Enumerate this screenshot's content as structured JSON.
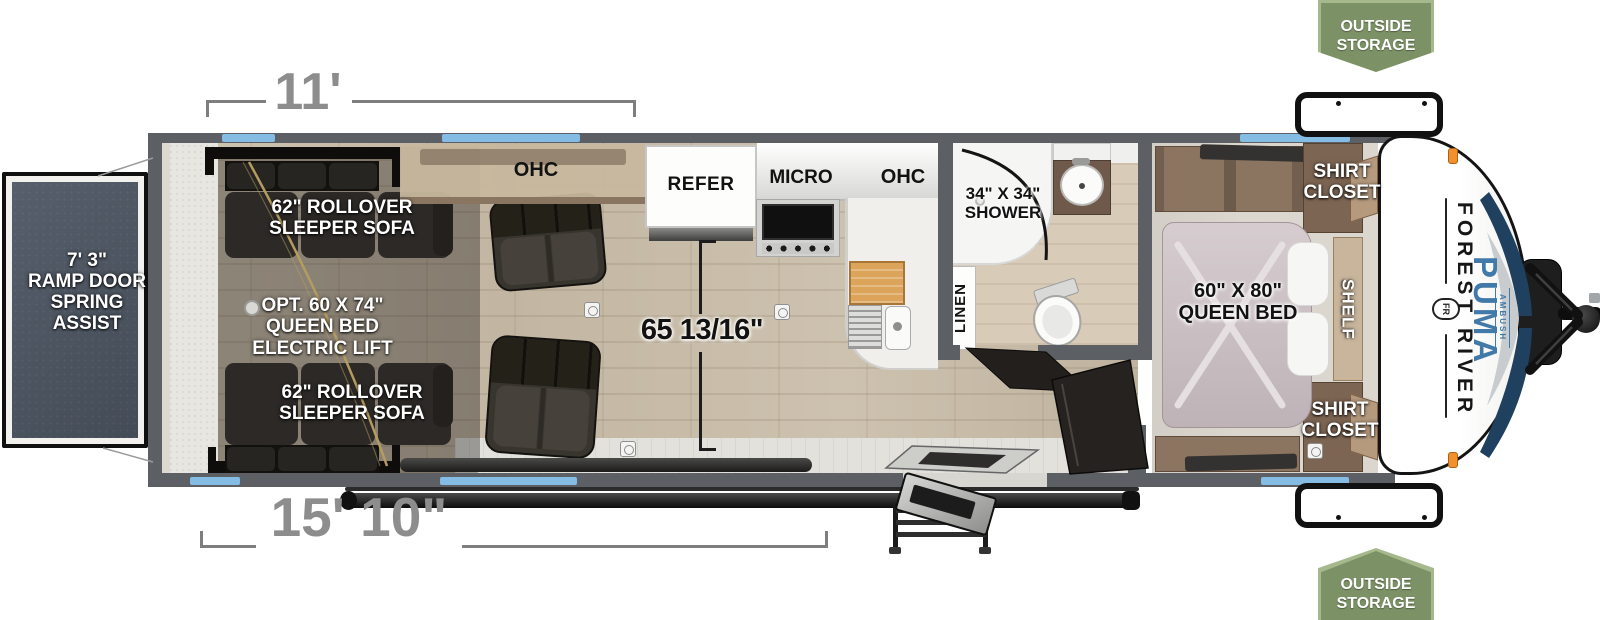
{
  "badges": {
    "top": {
      "label": "OUTSIDE STORAGE"
    },
    "bottom": {
      "label": "OUTSIDE STORAGE"
    }
  },
  "dimensions": {
    "garage_length": "11'",
    "cargo_length": "15' 10\"",
    "interior_width": "65 13/16\"",
    "ramp": "7' 3\"\nRAMP DOOR\nSPRING ASSIST"
  },
  "garage": {
    "sofa_top": "62\" ROLLOVER\nSLEEPER SOFA",
    "sofa_bottom": "62\" ROLLOVER\nSLEEPER SOFA",
    "bed_option": "OPT. 60 X 74\"\nQUEEN BED\nELECTRIC LIFT"
  },
  "kitchen": {
    "ohc_left": "OHC",
    "refer": "REFER",
    "micro": "MICRO",
    "ohc_right": "OHC"
  },
  "bathroom": {
    "shower": "34\" X 34\"\nSHOWER",
    "linen": "LINEN"
  },
  "bedroom": {
    "bed": "60\" X 80\"\nQUEEN BED",
    "shirt_closet_top": "SHIRT\nCLOSET",
    "shirt_closet_bottom": "SHIRT\nCLOSET",
    "shelf": "SHELF"
  },
  "branding": {
    "manufacturer": "FOREST RIVER",
    "model": "PUMA",
    "series": "AMBUSH",
    "logo": "FR"
  },
  "colors": {
    "window_blue": "#84bce4",
    "badge_green": "#7c9165",
    "badge_border": "#a6b98c",
    "brand_blue": "#417aa9",
    "swoosh_navy": "#20405f",
    "dimension_gray": "#8d8d8d",
    "wall_gray": "#5c6064",
    "ramp_slate": "#4d5663",
    "accent_orange": "#f0912d"
  }
}
